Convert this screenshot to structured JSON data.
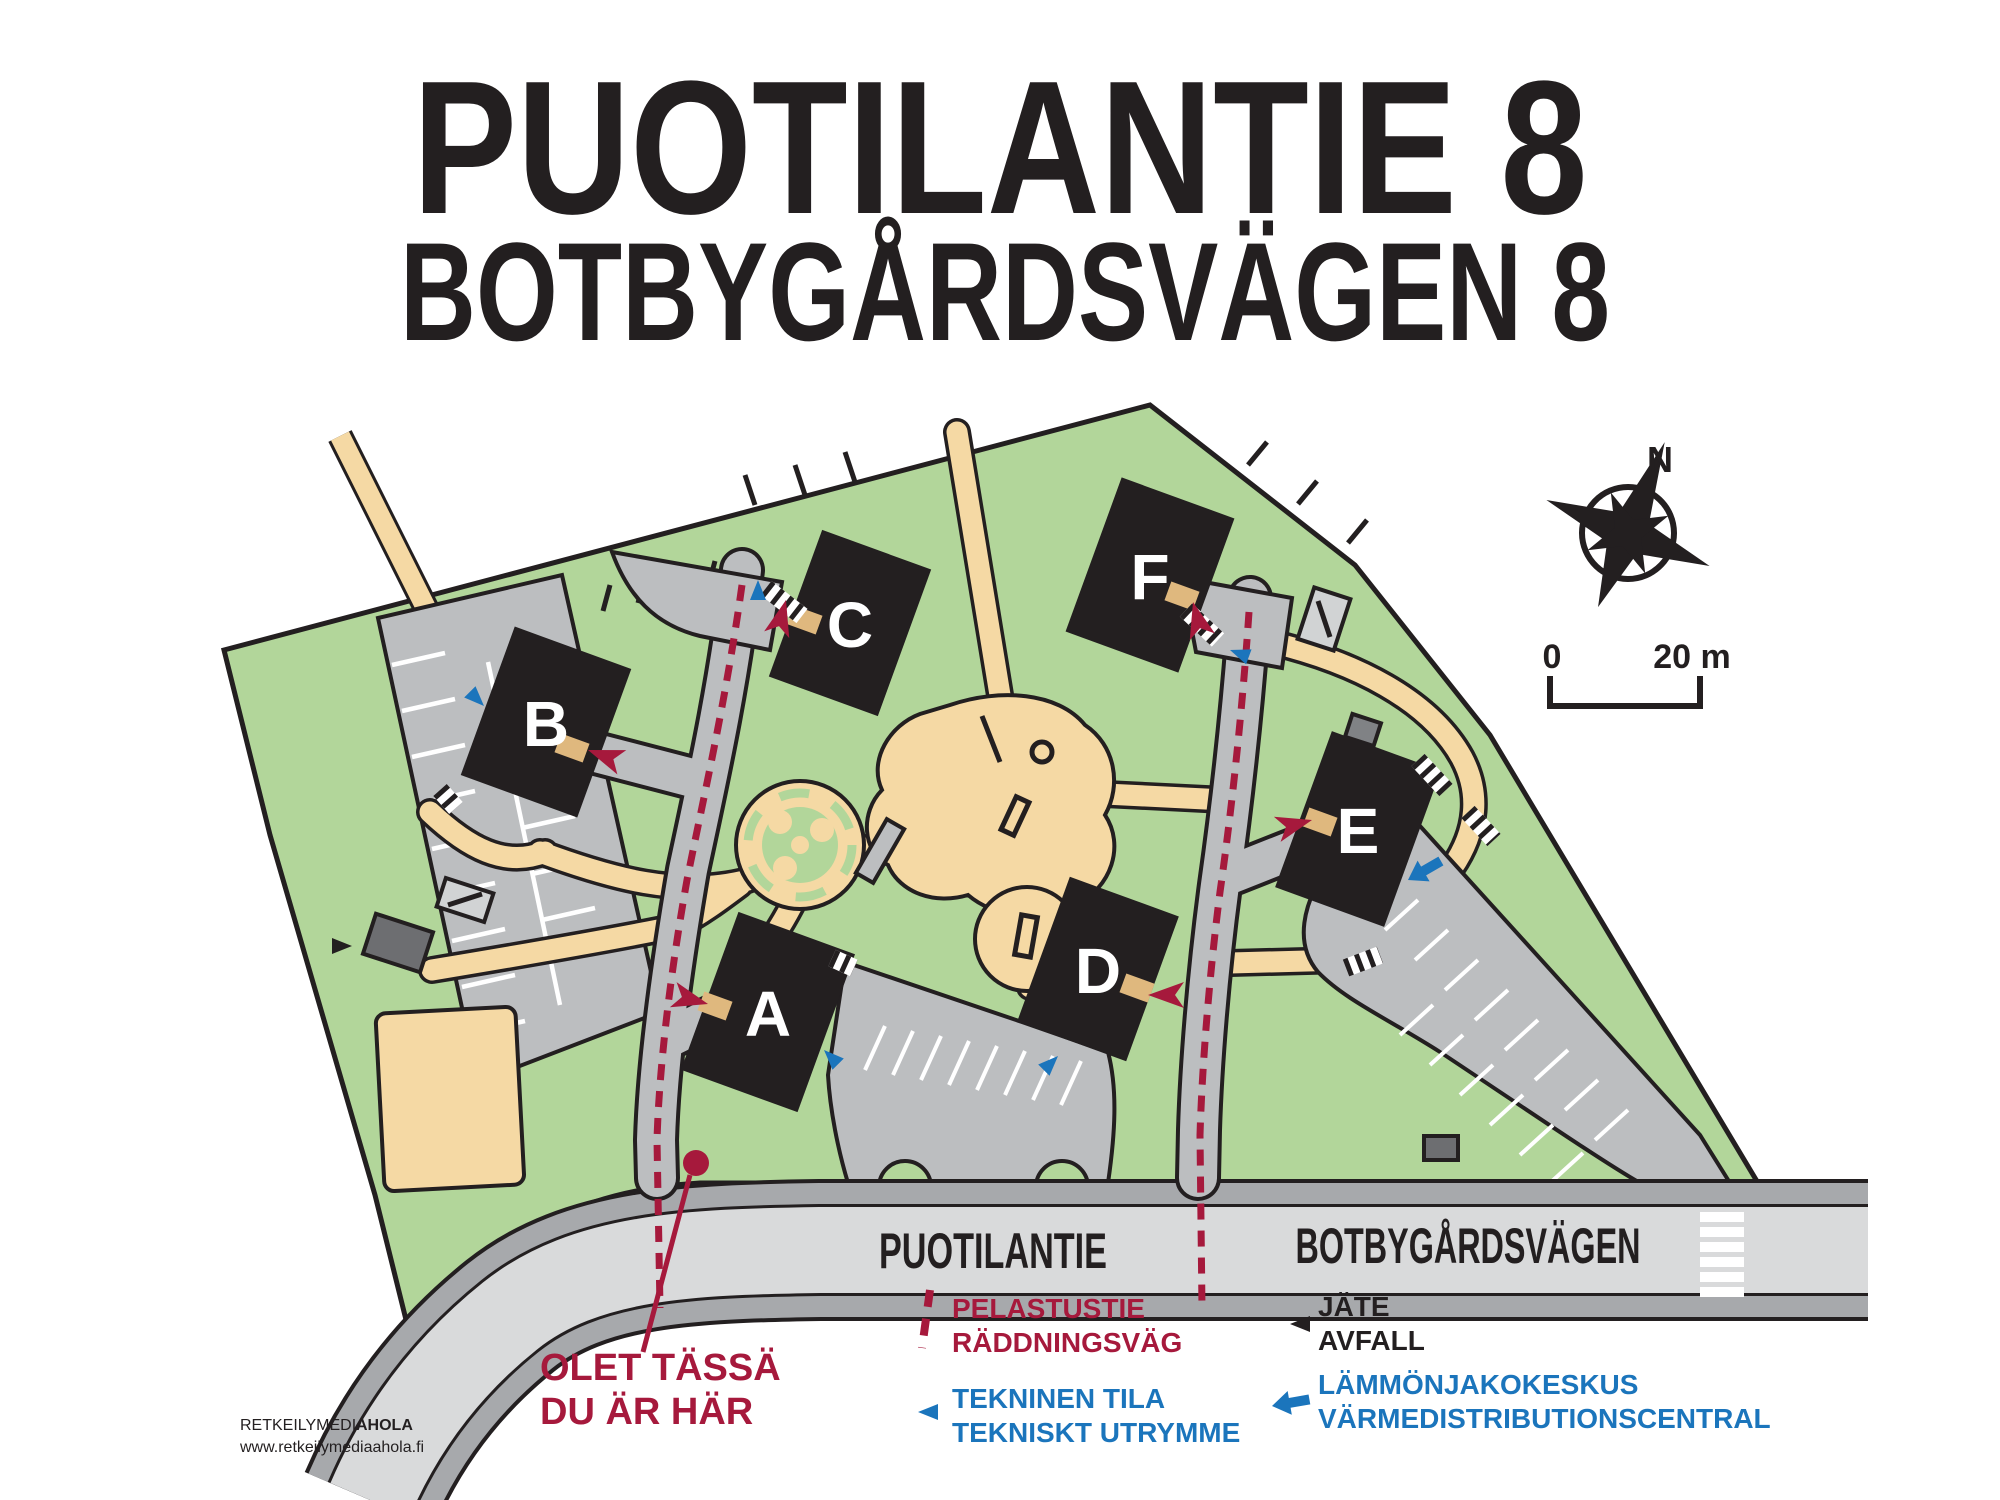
{
  "title": {
    "line1": "PUOTILANTIE 8",
    "line2": "BOTBYGÅRDSVÄGEN 8"
  },
  "map": {
    "buildings": [
      {
        "label": "A"
      },
      {
        "label": "B"
      },
      {
        "label": "C"
      },
      {
        "label": "D"
      },
      {
        "label": "E"
      },
      {
        "label": "F"
      }
    ],
    "streets": {
      "left": "PUOTILANTIE",
      "right": "BOTBYGÅRDSVÄGEN"
    },
    "you_are_here": {
      "line1": "OLET TÄSSÄ",
      "line2": "DU ÄR HÄR"
    },
    "compass": {
      "north": "N"
    },
    "scale_bar": {
      "zero": "0",
      "max": "20 m"
    }
  },
  "legend": {
    "items": [
      {
        "name": "rescue-route",
        "icon": "red-dashed-line",
        "line1": "PELASTUSTIE",
        "line2": "RÄDDNINGSVÄG"
      },
      {
        "name": "technical-room",
        "icon": "blue-triangle-left",
        "line1": "TEKNINEN TILA",
        "line2": "TEKNISKT UTRYMME"
      },
      {
        "name": "waste",
        "icon": "black-triangle-left",
        "line1": "JÄTE",
        "line2": "AVFALL"
      },
      {
        "name": "heat-distribution",
        "icon": "blue-arrow-left",
        "line1": "LÄMMÖNJAKOKESKUS",
        "line2": "VÄRMEDISTRIBUTIONSCENTRAL"
      }
    ]
  },
  "credits": {
    "publisher": "RETKEILYMEDIA",
    "publisher_bold": "AHOLA",
    "website": "www.retkeilymediaahola.fi"
  },
  "colors": {
    "site_green": "#b2d69a",
    "path_tan": "#f5d9a4",
    "road_gray": "#bcbec0",
    "road_light": "#d9dadb",
    "road_dark": "#a7a9ac",
    "building_black": "#231f20",
    "rescue_red": "#a6193c",
    "technical_blue": "#1b75bc"
  }
}
